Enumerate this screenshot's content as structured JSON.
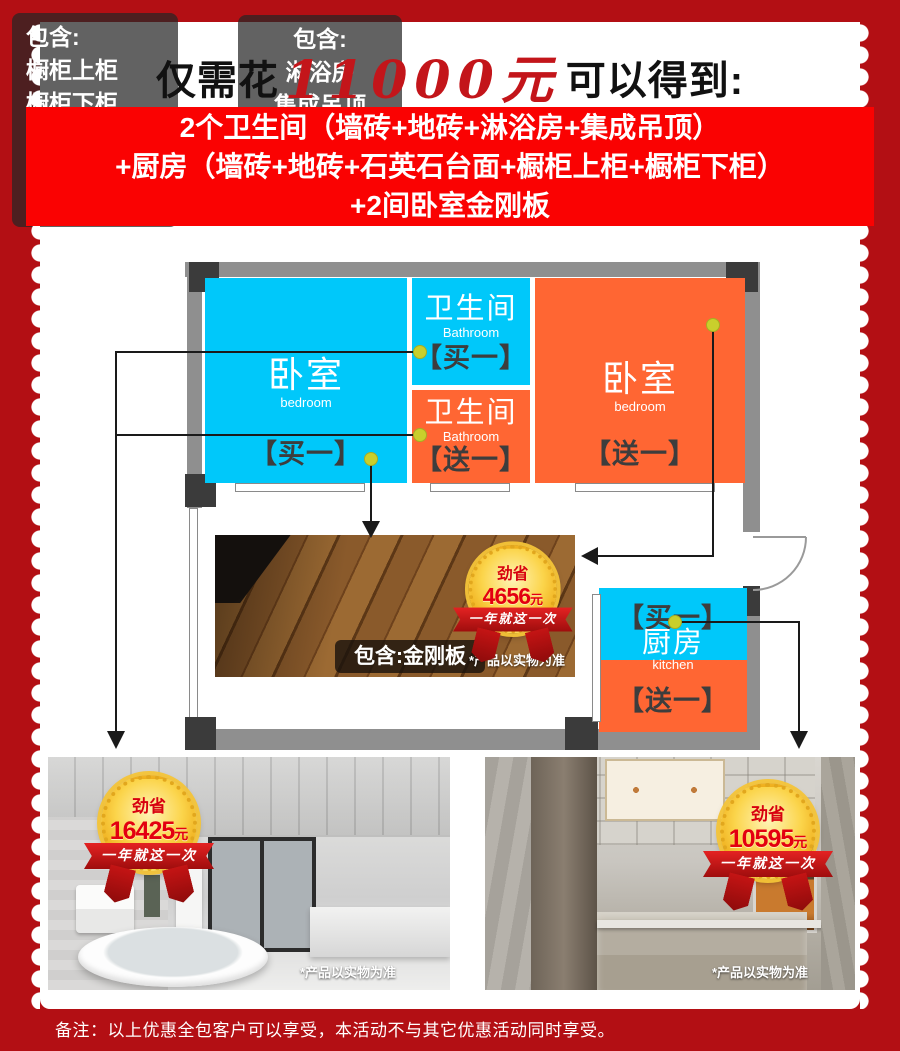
{
  "palette": {
    "background_red": "#b30f14",
    "banner_red": "#fa0202",
    "buy_cyan": "#00c8fa",
    "free_orange": "#ff6633",
    "wall_gray": "#8f8f8f",
    "marker_yellow": "#c9cf2c",
    "badge_gold": "#f6c33c",
    "badge_text_red": "#d7000f"
  },
  "header": {
    "title_prefix": "仅需花",
    "title_price": "11000",
    "title_yuan": "元",
    "title_suffix": "可以得到:"
  },
  "offer_banner": {
    "lines": [
      "2个卫生间（墙砖+地砖+淋浴房+集成吊顶）",
      "+厨房（墙砖+地砖+石英石台面+橱柜上柜+橱柜下柜）",
      "+2间卧室金刚板"
    ]
  },
  "floorplan": {
    "bedroom_left": {
      "name": "卧室",
      "name_en": "bedroom",
      "tag": "【买一】"
    },
    "bathroom_top": {
      "name": "卫生间",
      "name_en": "Bathroom",
      "tag": "【买一】"
    },
    "bathroom_bottom": {
      "name": "卫生间",
      "name_en": "Bathroom",
      "tag": "【送一】"
    },
    "bedroom_right": {
      "name": "卧室",
      "name_en": "bedroom",
      "tag": "【送一】"
    },
    "kitchen": {
      "name": "厨房",
      "name_en": "kitchen",
      "tag_buy": "【买一】",
      "tag_free": "【送一】"
    }
  },
  "floor_promo": {
    "badge": {
      "label": "劲省",
      "amount": "4656",
      "unit": "元",
      "ribbon": "一年就这一次"
    },
    "includes_label": "包含:金刚板",
    "disclaimer": "*产品以实物为准"
  },
  "bathroom_promo": {
    "badge": {
      "label": "劲省",
      "amount": "16425",
      "unit": "元",
      "ribbon": "一年就这一次"
    },
    "includes_title": "包含:",
    "includes": [
      "淋浴房",
      "集成吊顶",
      "卫生间墙砖",
      "卫生间地砖"
    ],
    "disclaimer": "*产品以实物为准"
  },
  "kitchen_promo": {
    "badge": {
      "label": "劲省",
      "amount": "10595",
      "unit": "元",
      "ribbon": "一年就这一次"
    },
    "includes_title": "包含:",
    "includes": [
      "橱柜上柜",
      "橱柜下柜",
      "石英石台面",
      "厨房墙砖",
      "厨房地砖"
    ],
    "disclaimer": "*产品以实物为准"
  },
  "footer": {
    "note": "备注：以上优惠全包客户可以享受，本活动不与其它优惠活动同时享受。"
  }
}
